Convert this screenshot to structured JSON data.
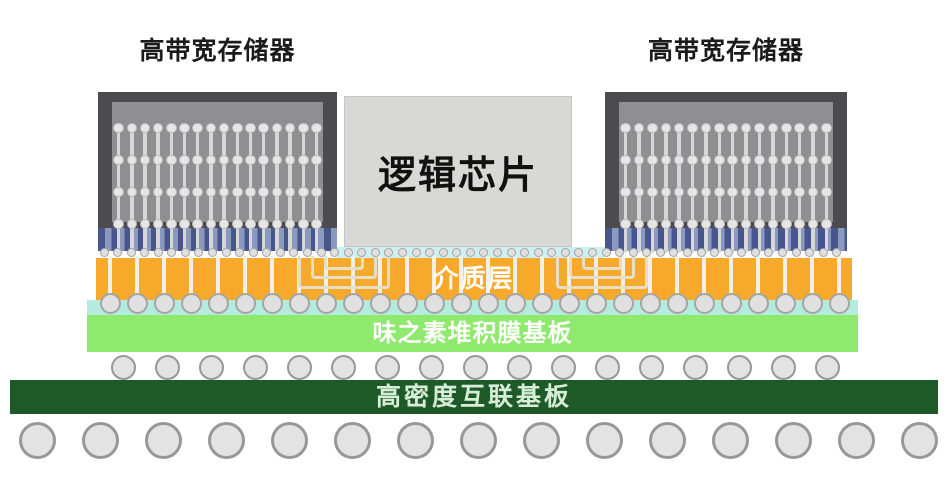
{
  "labels": {
    "hbm_left": "高带宽存储器",
    "hbm_right": "高带宽存储器",
    "logic_chip": "逻辑芯片",
    "dielectric": "介质层",
    "abf_substrate": "味之素堆积膜基板",
    "hdi_board": "高密度互联基板"
  },
  "colors": {
    "background": "#ffffff",
    "hbm_frame": "#4c4c50",
    "hbm_body": "#8f8f91",
    "tsv_ball": "#e6e6e6",
    "tsv_stem": "#d7d7d7",
    "base_die_dark": "#47578e",
    "base_die_light": "#8b99bf",
    "logic_chip_fill": "#d8d8d6",
    "underfill_cyan": "#cdeff0",
    "dielectric_orange": "#f7a92b",
    "trace": "#e6dfc6",
    "via_fill": "#f2f0e8",
    "bump_fill": "#e0e0e0",
    "bump_edge": "#a5a5a5",
    "abf_cyan": "#b3ecdf",
    "abf_green": "#8fe96e",
    "board_green": "#1d5a28",
    "ball_fill": "#e3e3e3",
    "ball_edge": "#979797",
    "label_text": "#1b1b1b",
    "layer_text": "#ffffff",
    "board_text": "#d6edd8"
  },
  "geometry": {
    "hbm_stacks": [
      {
        "frame_x": 98,
        "frame_w": 239,
        "inner_x": 112,
        "inner_w": 211,
        "spacing": 13.19
      },
      {
        "frame_x": 605,
        "frame_w": 242,
        "inner_x": 619,
        "inner_w": 214,
        "spacing": 13.38
      }
    ],
    "tsv": {
      "columns": 16,
      "row_ys": [
        128,
        160,
        192,
        224
      ],
      "ball_d": 10.5,
      "stem_top": 126,
      "stem_bottom": 253,
      "stem_w": 3.5
    },
    "microbumps": {
      "count": 55,
      "x0": 104,
      "spacing": 13.57,
      "cy": 252.5,
      "d": 9
    },
    "vias": {
      "count": 28,
      "x0": 110,
      "spacing": 27,
      "top": 256,
      "bottom": 301,
      "w": 4.5,
      "bump_cy": 303,
      "bump_d": 21
    },
    "traces": {
      "centers": [
        344,
        602
      ],
      "top": 256,
      "widths": [
        92,
        66,
        40
      ],
      "heights": [
        33,
        23,
        14
      ]
    },
    "mid_balls": {
      "count": 17,
      "x0": 123,
      "spacing": 44,
      "cy": 367,
      "d": 25
    },
    "bottom_balls": {
      "count": 15,
      "x0": 37,
      "spacing": 63,
      "cy": 440,
      "d": 37
    }
  }
}
